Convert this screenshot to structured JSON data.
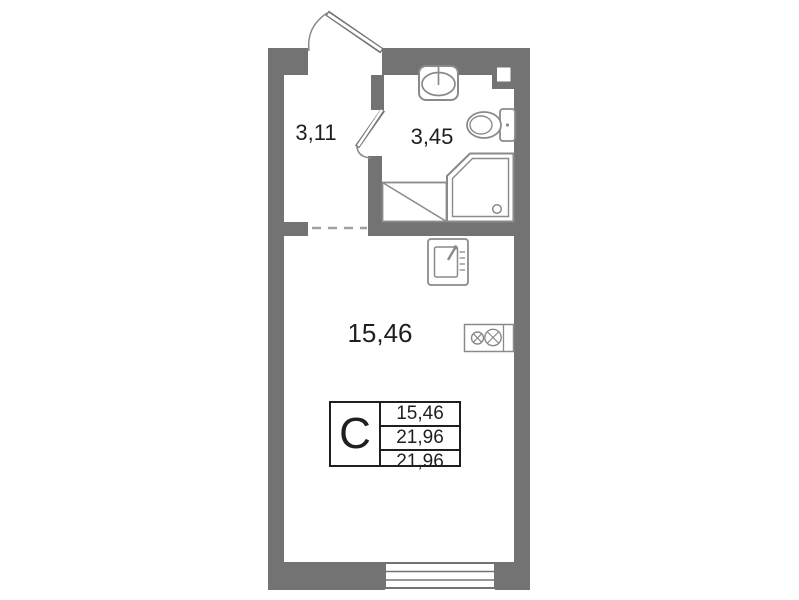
{
  "plan": {
    "rooms": [
      {
        "id": "hallway",
        "area": "3,11"
      },
      {
        "id": "bathroom",
        "area": "3,45"
      },
      {
        "id": "living_kitchen",
        "area": "15,46"
      }
    ],
    "info_table": {
      "type": "С",
      "values": [
        "15,46",
        "21,96",
        "21,96"
      ]
    },
    "colors": {
      "wall": "#737373",
      "fixture_outline": "#8a8a8a",
      "text": "#1f1f1f",
      "background": "#ffffff"
    },
    "fixtures": [
      "entrance-door",
      "bathroom-door",
      "bathroom-sink",
      "toilet",
      "shower-tray",
      "washing-machine-space",
      "kitchen-sink",
      "stove",
      "balcony-window",
      "vent-shaft",
      "room-divider-dashed-line"
    ]
  }
}
